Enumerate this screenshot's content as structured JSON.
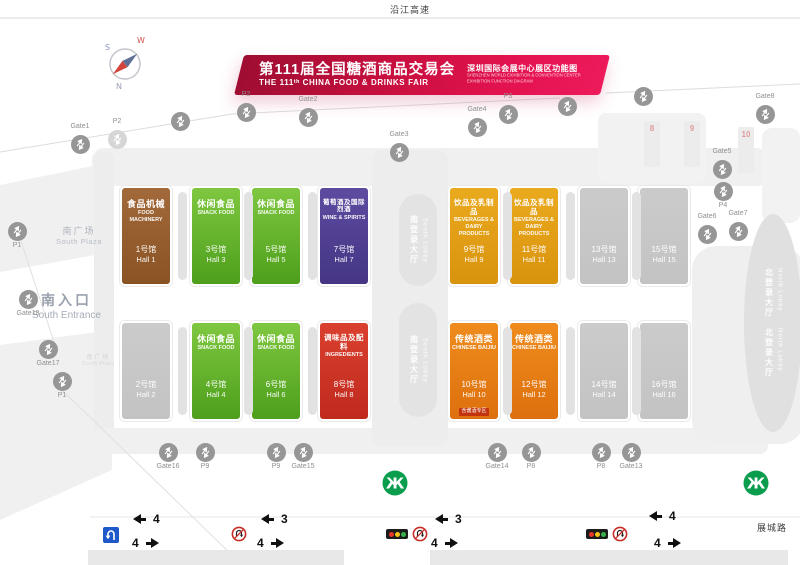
{
  "roads": {
    "top": "沿江高速",
    "bottom_right": "展城路"
  },
  "compass": {
    "n": "N",
    "s": "S",
    "w": "W"
  },
  "banner": {
    "title_cn": "第111届全国糖酒商品交易会",
    "title_en": "THE 111ᵗʰ CHINA FOOD & DRINKS FAIR",
    "subtitle_cn": "深圳国际会展中心展区功能图",
    "subtitle_en_1": "SHENZHEN WORLD EXHIBITION & CONVENTION CENTER",
    "subtitle_en_2": "EXHIBITION FUNCTION DIAGRAM"
  },
  "colors": {
    "machinery": [
      "#a2693a",
      "#8a5323"
    ],
    "snack": [
      "#7fc740",
      "#4d9f1c"
    ],
    "wine": [
      "#5d4ba0",
      "#453584"
    ],
    "beverage": [
      "#eaaa1e",
      "#d9930e"
    ],
    "ingredients": [
      "#da402f",
      "#bf2a1d"
    ],
    "baijiu": [
      "#ef8c1d",
      "#dd700e"
    ],
    "empty": [
      "#cbcbcb",
      "#c3c3c3"
    ]
  },
  "halls": [
    {
      "id": 1,
      "row": 0,
      "col": 0,
      "cat": "machinery",
      "name_cn": "食品机械",
      "name_en": "FOOD MACHINERY",
      "no_cn": "1号馆",
      "no_en": "Hall 1"
    },
    {
      "id": 3,
      "row": 0,
      "col": 1,
      "cat": "snack",
      "name_cn": "休闲食品",
      "name_en": "SNACK FOOD",
      "no_cn": "3号馆",
      "no_en": "Hall 3"
    },
    {
      "id": 5,
      "row": 0,
      "col": 2,
      "cat": "snack",
      "name_cn": "休闲食品",
      "name_en": "SNACK FOOD",
      "no_cn": "5号馆",
      "no_en": "Hall 5"
    },
    {
      "id": 7,
      "row": 0,
      "col": 3,
      "cat": "wine",
      "name_cn": "葡萄酒及国际烈酒",
      "name_en": "WINE & SPIRITS",
      "no_cn": "7号馆",
      "no_en": "Hall 7"
    },
    {
      "id": 9,
      "row": 0,
      "col": 4,
      "cat": "beverage",
      "name_cn": "饮品及乳制品",
      "name_en": "BEVERAGES & DAIRY PRODUCTS",
      "no_cn": "9号馆",
      "no_en": "Hall 9"
    },
    {
      "id": 11,
      "row": 0,
      "col": 5,
      "cat": "beverage",
      "name_cn": "饮品及乳制品",
      "name_en": "BEVERAGES & DAIRY PRODUCTS",
      "no_cn": "11号馆",
      "no_en": "Hall 11"
    },
    {
      "id": 13,
      "row": 0,
      "col": 6,
      "cat": "empty",
      "name_cn": "",
      "name_en": "",
      "no_cn": "13号馆",
      "no_en": "Hall 13"
    },
    {
      "id": 15,
      "row": 0,
      "col": 7,
      "cat": "empty",
      "name_cn": "",
      "name_en": "",
      "no_cn": "15号馆",
      "no_en": "Hall 15"
    },
    {
      "id": 2,
      "row": 1,
      "col": 0,
      "cat": "empty",
      "name_cn": "",
      "name_en": "",
      "no_cn": "2号馆",
      "no_en": "Hall 2"
    },
    {
      "id": 4,
      "row": 1,
      "col": 1,
      "cat": "snack",
      "name_cn": "休闲食品",
      "name_en": "SNACK FOOD",
      "no_cn": "4号馆",
      "no_en": "Hall 4"
    },
    {
      "id": 6,
      "row": 1,
      "col": 2,
      "cat": "snack",
      "name_cn": "休闲食品",
      "name_en": "SNACK FOOD",
      "no_cn": "6号馆",
      "no_en": "Hall 6"
    },
    {
      "id": 8,
      "row": 1,
      "col": 3,
      "cat": "ingredients",
      "name_cn": "调味品及配料",
      "name_en": "INGREDIENTS",
      "no_cn": "8号馆",
      "no_en": "Hall 8"
    },
    {
      "id": 10,
      "row": 1,
      "col": 4,
      "cat": "baijiu",
      "name_cn": "传统酒类",
      "name_en": "CHINESE BAIJIU",
      "no_cn": "10号馆",
      "no_en": "Hall 10",
      "note_cn": "含酱酒专区"
    },
    {
      "id": 12,
      "row": 1,
      "col": 5,
      "cat": "baijiu",
      "name_cn": "传统酒类",
      "name_en": "CHINESE BAIJIU",
      "no_cn": "12号馆",
      "no_en": "Hall 12"
    },
    {
      "id": 14,
      "row": 1,
      "col": 6,
      "cat": "empty",
      "name_cn": "",
      "name_en": "",
      "no_cn": "14号馆",
      "no_en": "Hall 14"
    },
    {
      "id": 16,
      "row": 1,
      "col": 7,
      "cat": "empty",
      "name_cn": "",
      "name_en": "",
      "no_cn": "16号馆",
      "no_en": "Hall 16"
    }
  ],
  "lobbies": {
    "south_cn": "南登录大厅",
    "south_en": "South Lobby",
    "north_cn": "北登录大厅",
    "north_en": "North Lobby"
  },
  "areas": {
    "south_plaza_cn": "南广场",
    "south_plaza_en": "South Plaza",
    "south_entrance_cn": "南入口",
    "south_entrance_en": "South Entrance"
  },
  "north_hall_numbers": [
    "8",
    "9",
    "10"
  ],
  "gates": [
    {
      "id": "g1",
      "label": "Gate1"
    },
    {
      "id": "p2a",
      "label": "P2"
    },
    {
      "id": "u1",
      "label": ""
    },
    {
      "id": "p2b",
      "label": "P2"
    },
    {
      "id": "g2",
      "label": "Gate2"
    },
    {
      "id": "g3",
      "label": "Gate3"
    },
    {
      "id": "g4",
      "label": "Gate4"
    },
    {
      "id": "p3a",
      "label": "P3"
    },
    {
      "id": "u2",
      "label": ""
    },
    {
      "id": "u3",
      "label": ""
    },
    {
      "id": "g8",
      "label": "Gate8"
    },
    {
      "id": "g5",
      "label": "Gate5"
    },
    {
      "id": "p4",
      "label": "P4"
    },
    {
      "id": "g6",
      "label": "Gate6"
    },
    {
      "id": "g7",
      "label": "Gate7"
    },
    {
      "id": "p1a",
      "label": "P1"
    },
    {
      "id": "g18",
      "label": "Gate18"
    },
    {
      "id": "g17",
      "label": "Gate17"
    },
    {
      "id": "p1b",
      "label": "P1"
    },
    {
      "id": "g16",
      "label": "Gate16"
    },
    {
      "id": "p9a",
      "label": "P9"
    },
    {
      "id": "p9b",
      "label": "P9"
    },
    {
      "id": "g15",
      "label": "Gate15"
    },
    {
      "id": "g14",
      "label": "Gate14"
    },
    {
      "id": "p8a",
      "label": "P8"
    },
    {
      "id": "p8b",
      "label": "P8"
    },
    {
      "id": "g13",
      "label": "Gate13"
    }
  ],
  "traffic": {
    "groups": [
      {
        "left": "4",
        "right": "4"
      },
      {
        "left": "3",
        "right": "4"
      },
      {
        "left": "3",
        "right": "4"
      },
      {
        "left": "4",
        "right": "4"
      }
    ]
  }
}
